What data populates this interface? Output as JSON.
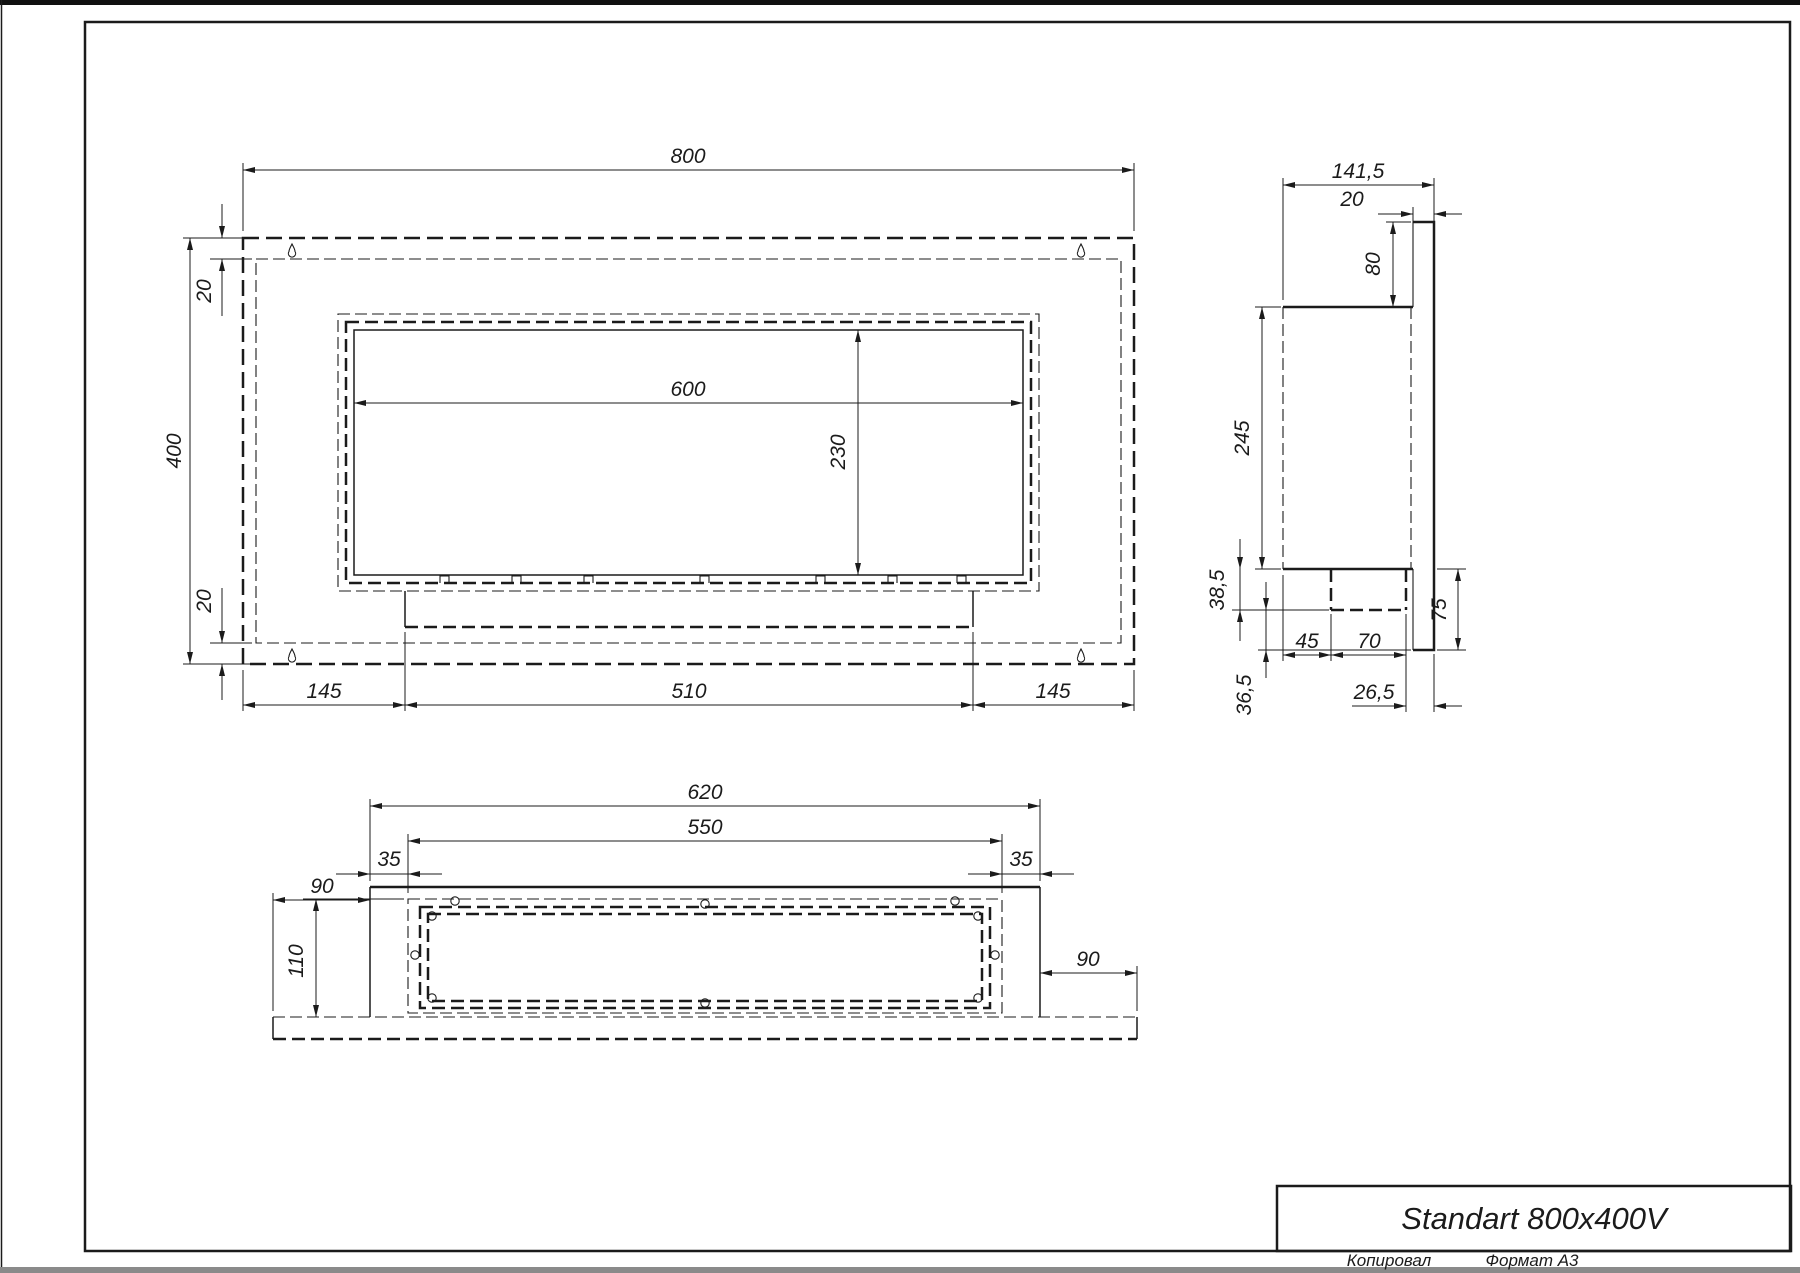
{
  "title_block": {
    "title": "Standart 800x400V"
  },
  "sheet": {
    "footer": {
      "copied": "Копировал",
      "format": "Формат А3"
    }
  },
  "front_view": {
    "dims": {
      "overall_width": "800",
      "overall_height": "400",
      "top_inset": "20",
      "bottom_inset": "20",
      "opening_width": "600",
      "opening_height": "230",
      "bottom_left": "145",
      "bottom_center": "510",
      "bottom_right": "145"
    }
  },
  "side_view": {
    "dims": {
      "overall_depth": "141,5",
      "plate_thickness": "20",
      "top_offset": "80",
      "body_height": "245",
      "tray_height": "38,5",
      "tray_front_gap": "45",
      "tray_width": "70",
      "tray_back_gap": "26,5",
      "plate_bottom_drop": "75",
      "bottom_gap": "36,5"
    }
  },
  "bottom_view": {
    "dims": {
      "body_width": "620",
      "opening_width": "550",
      "margin_left": "35",
      "margin_right": "35",
      "flange_left": "90",
      "flange_right": "90",
      "depth": "110"
    }
  }
}
